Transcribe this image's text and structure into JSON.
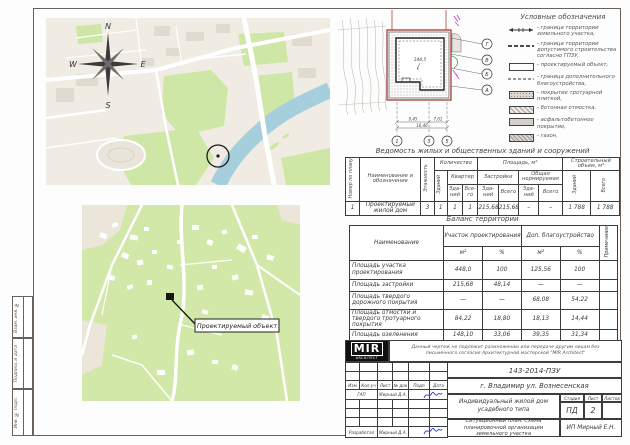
{
  "frame_strip": {
    "vzam": "Взам. инв. №",
    "podpis": "Подпись и дата",
    "inv": "Инв. № подл."
  },
  "map_city": {
    "compass": {
      "n": "N",
      "e": "E",
      "s": "S",
      "w": "W"
    }
  },
  "map_area": {
    "object_label": "Проектируемый объект"
  },
  "site_plan": {
    "axes_bottom": [
      "1",
      "3",
      "5"
    ],
    "axes_right": [
      "Г",
      "В",
      "Б",
      "А"
    ],
    "dims": {
      "d1": "9,45",
      "d2": "7,01",
      "total": "16,46"
    },
    "elevation": "144,5"
  },
  "legend": {
    "title": "Условные обозначения",
    "items": [
      {
        "symbol": "boundary-line",
        "label": "- граница территории земельного участка,"
      },
      {
        "symbol": "dashed-bold-line",
        "label": "- граница территории допустимого строительства согласно ГПЗУ,"
      },
      {
        "symbol": "white-rect",
        "label": "- проектируемый объект,"
      },
      {
        "symbol": "dashed-line",
        "label": "- граница дополнительного благоустройства,"
      },
      {
        "symbol": "dot-hatch-rect",
        "label": "- покрытие тротуарной плиткой,"
      },
      {
        "symbol": "diag-hatch-rect",
        "label": "- бетонная отмостка,"
      },
      {
        "symbol": "gray-rect",
        "label": "- асфальтобетонное покрытие,"
      },
      {
        "symbol": "cross-hatch-rect",
        "label": "- газон."
      }
    ]
  },
  "buildings_table": {
    "title": "Ведомость жилых и общественных зданий и сооружений",
    "h": {
      "num": "Номер по плану",
      "name": "Наименование и обозначение",
      "floors": "Этажность",
      "qty": "Количество",
      "qty_bld": "Зданий",
      "qty_apt": "Квартир",
      "bld_short": "Зда-ний",
      "total_short": "Все-го",
      "area": "Площадь, м²",
      "area_built": "Застройки",
      "area_norm": "Общая нормируемая",
      "total": "Всего",
      "volume": "Строительный объем, м³"
    },
    "row": {
      "num": "1",
      "name": "Проектируемый жилой дом",
      "floors": "3",
      "qty_bld": "1",
      "apt_bld": "1",
      "apt_total": "1",
      "built_bld": "215,68",
      "built_total": "215,68",
      "norm_bld": "–",
      "norm_total": "–",
      "vol_bld": "1 788",
      "vol_total": "1 788"
    }
  },
  "balance_table": {
    "title": "Баланс территории",
    "h": {
      "name": "Наименование",
      "site": "Участок проектирования",
      "dop": "Доп. благоустройство",
      "m2": "м²",
      "pct": "%",
      "note": "Примечание"
    },
    "rows": [
      {
        "name": "Площадь участка проектирования",
        "v": [
          "448,0",
          "100",
          "125,56",
          "100"
        ]
      },
      {
        "name": "Площадь застройки",
        "v": [
          "215,68",
          "48,14",
          "—",
          "—"
        ]
      },
      {
        "name": "Площадь твердого дорожного покрытия",
        "v": [
          "—",
          "—",
          "68,08",
          "54,22"
        ]
      },
      {
        "name": "Площадь отмостки и твердого тротуарного покрытия",
        "v": [
          "84,22",
          "18,80",
          "18,13",
          "14,44"
        ]
      },
      {
        "name": "Площадь озеленения",
        "v": [
          "148,10",
          "33,06",
          "39,35",
          "31,34"
        ]
      }
    ]
  },
  "title_block": {
    "logo_main": "MIR",
    "logo_sub": "ARCHITECT",
    "disclaimer": "Данный чертеж не подлежит размножению или передаче другим лицам без письменного согласия Архитектурной мастерской \"MIR Architect\"",
    "doc_number": "143-2014-ПЗУ",
    "location": "г. Владимир ул. Вознесенская",
    "cols": {
      "izm": "Изм",
      "koluch": "Кол.уч",
      "list": "Лист",
      "ndok": "№ док",
      "podp": "Подп",
      "data": "Дата"
    },
    "roles": [
      {
        "role": "ГАП",
        "name": "Мирный Д.А."
      },
      {
        "role": "Разработал",
        "name": "Мирный Д.А."
      }
    ],
    "project": "Индивидуальный жилой дом усадебного типа",
    "stage_label": "Стадия",
    "stage": "ПД",
    "sheet_label": "Лист",
    "sheet": "2",
    "sheets_label": "Листов",
    "sheet_title": "Ситуационный план. Схема планировочной организации земельного участка",
    "company": "ИП Мирный Е.Н."
  }
}
